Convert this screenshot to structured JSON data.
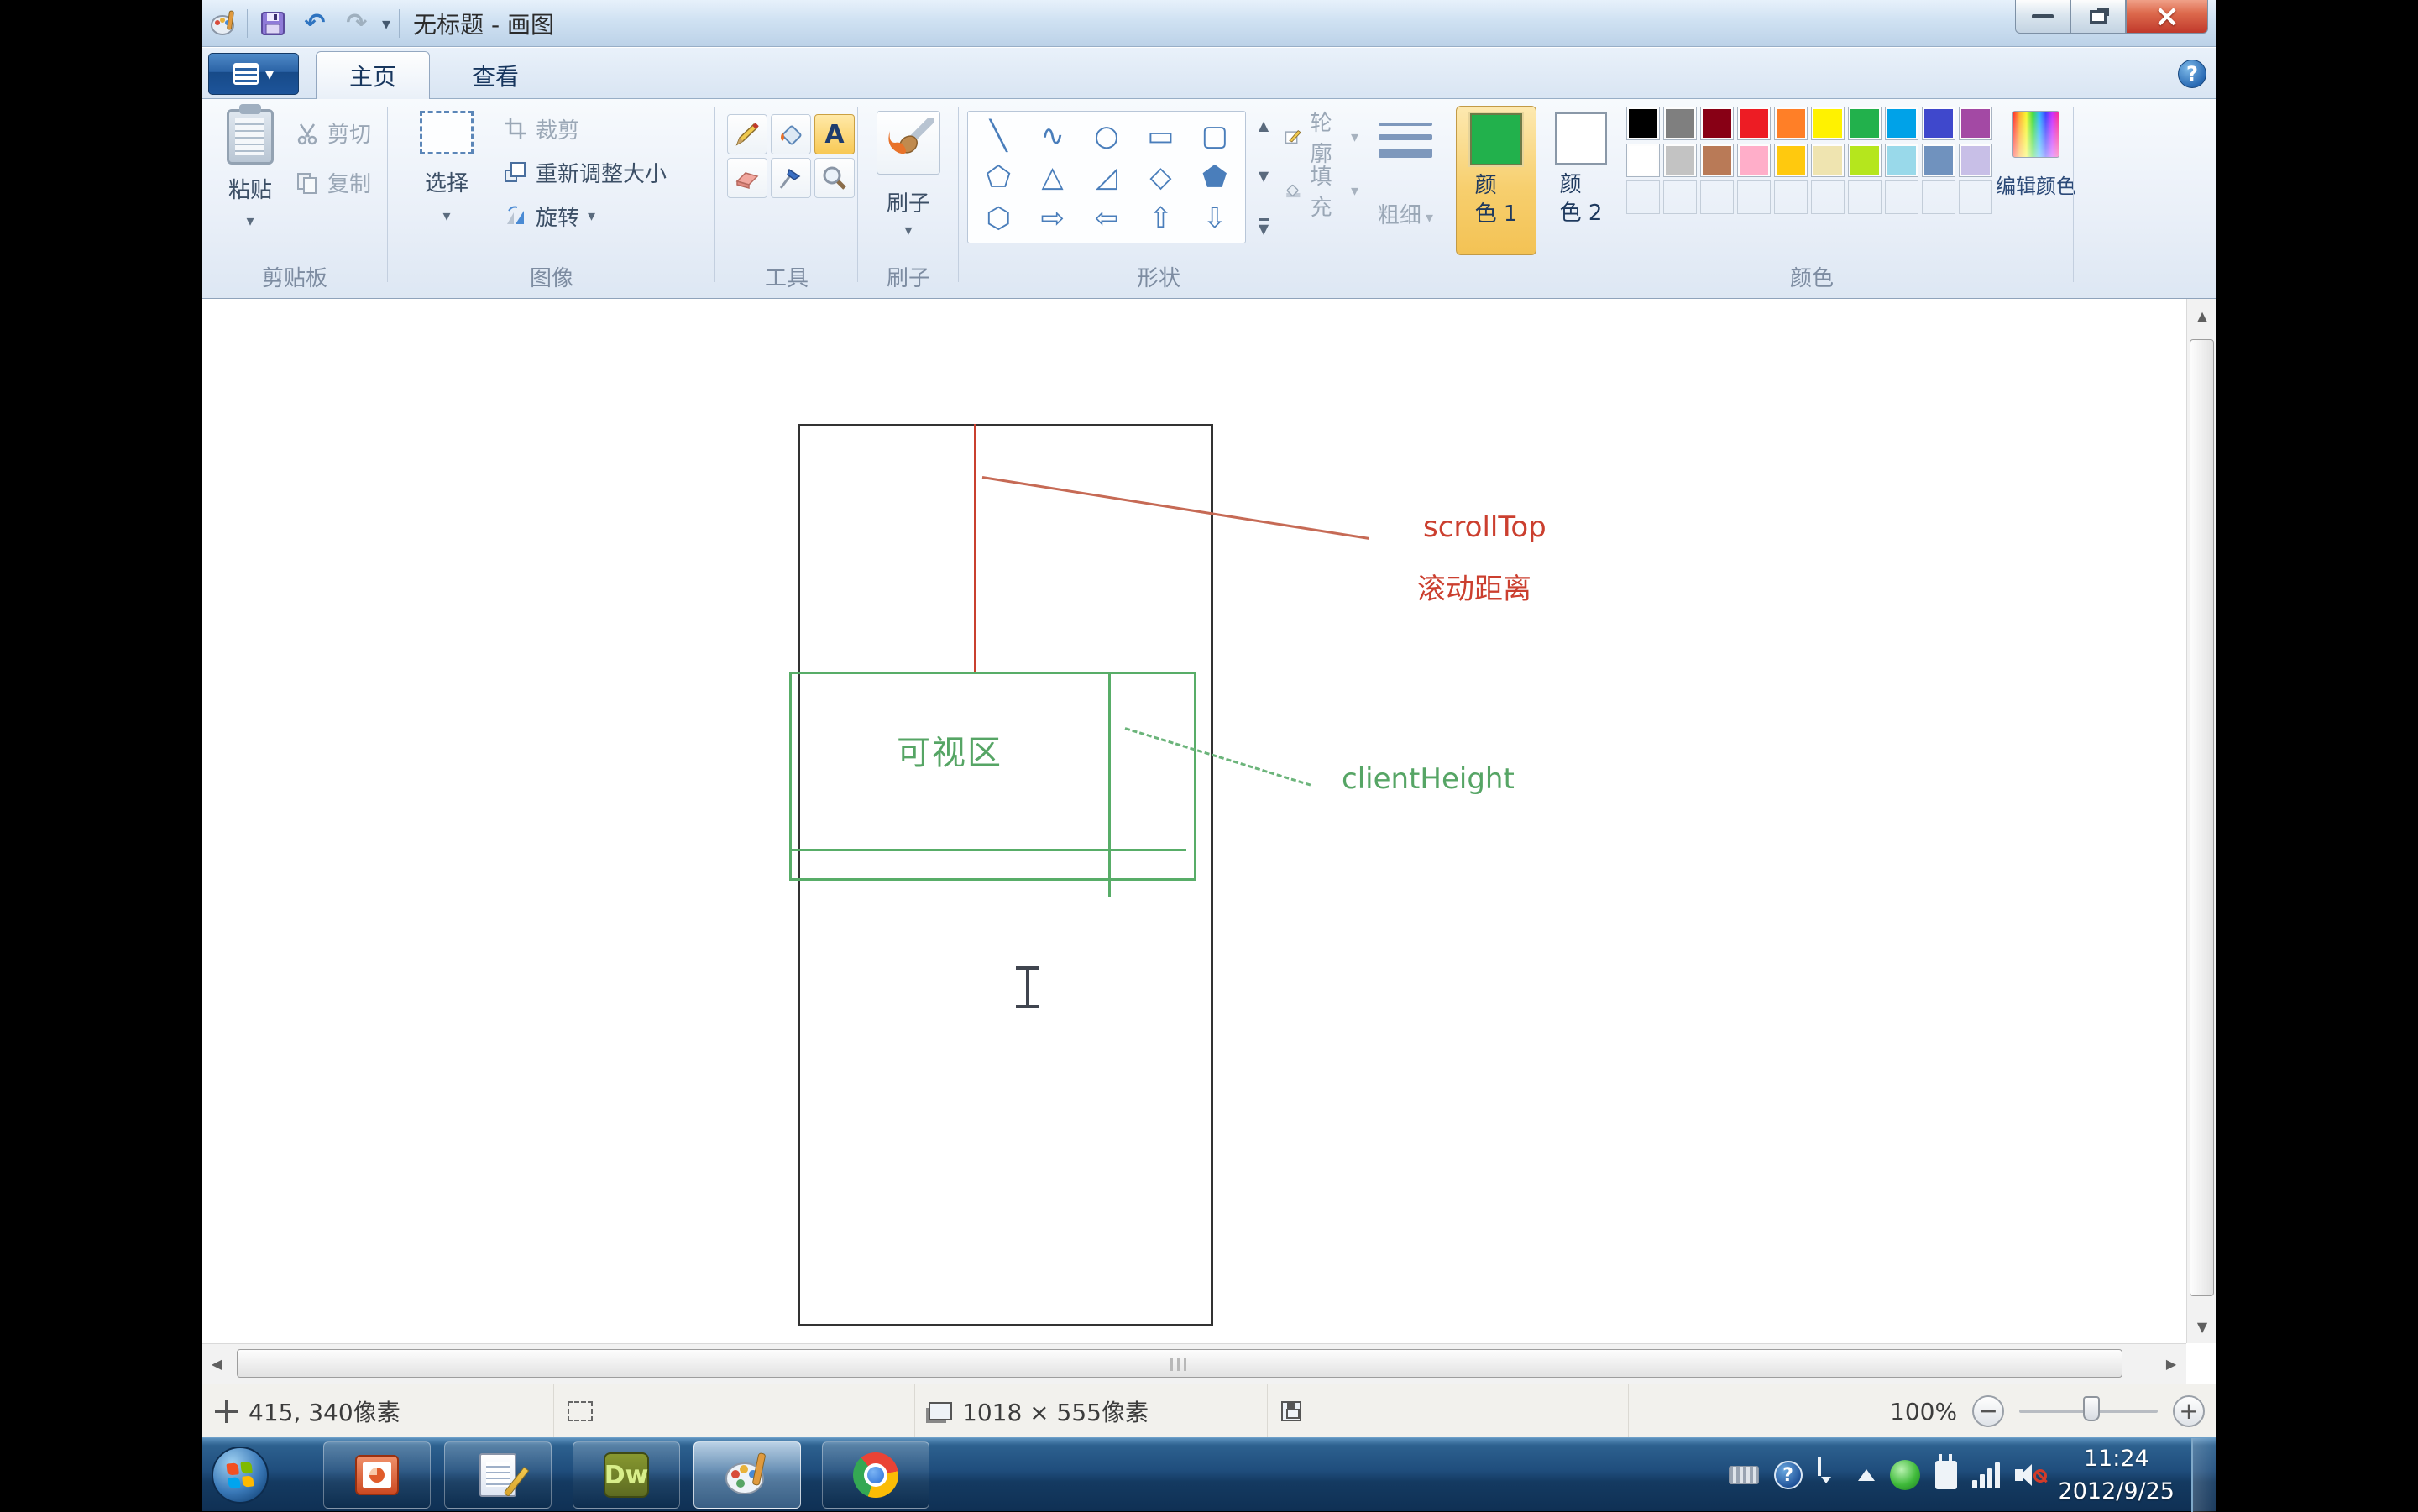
{
  "window": {
    "title": "无标题 - 画图",
    "close_glyph": "×"
  },
  "quick_access": {
    "undo_glyph": "↶",
    "redo_glyph": "↷",
    "dropdown_glyph": "▾"
  },
  "tabs": {
    "home": "主页",
    "view": "查看"
  },
  "help_glyph": "?",
  "ribbon": {
    "clipboard": {
      "label": "剪贴板",
      "paste": "粘贴",
      "cut": "剪切",
      "copy": "复制"
    },
    "image": {
      "label": "图像",
      "select": "选择",
      "crop": "裁剪",
      "resize": "重新调整大小",
      "rotate": "旋转"
    },
    "tools": {
      "label": "工具",
      "text_tool": "A"
    },
    "brushes": {
      "label": "刷子"
    },
    "shapes": {
      "label": "形状",
      "outline": "轮廓",
      "fill": "填充",
      "glyphs": [
        "╲",
        "∿",
        "○",
        "▭",
        "▢",
        "⬠",
        "△",
        "◿",
        "◇",
        "⬟",
        "⬡",
        "⇨",
        "⇦",
        "⇧",
        "⇩"
      ],
      "up": "▲",
      "down": "▼",
      "more": "▼"
    },
    "size": {
      "label": "粗细"
    },
    "colors": {
      "label": "颜色",
      "color1_label_a": "颜",
      "color1_label_b": "色 1",
      "color2_label_a": "颜",
      "color2_label_b": "色 2",
      "edit_label": "编辑颜色",
      "color1": "#22b14c",
      "color2": "#ffffff",
      "palette_row1": [
        "#000000",
        "#7f7f7f",
        "#880015",
        "#ed1c24",
        "#ff7f27",
        "#fff200",
        "#22b14c",
        "#00a2e8",
        "#3f48cc",
        "#a349a4"
      ],
      "palette_row2": [
        "#ffffff",
        "#c3c3c3",
        "#b97a57",
        "#ffaec9",
        "#ffc90e",
        "#efe4b0",
        "#b5e61d",
        "#99d9ea",
        "#7092be",
        "#c8bfe7"
      ],
      "palette_empty": 10
    }
  },
  "drawing": {
    "scroll_top": "scrollTop",
    "scroll_distance": "滚动距离",
    "viewport": "可视区",
    "client_height": "clientHeight",
    "red": "#cb3f2f",
    "green": "#58ad68"
  },
  "scrollbars": {
    "up": "▲",
    "down": "▼",
    "left": "◀",
    "right": "▶"
  },
  "statusbar": {
    "cursor_pos": "415, 340像素",
    "canvas_size": "1018 × 555像素",
    "zoom_level": "100%",
    "minus": "−",
    "plus": "+"
  },
  "taskbar": {
    "dreamweaver_label": "Dw",
    "time": "11:24",
    "date": "2012/9/25"
  }
}
